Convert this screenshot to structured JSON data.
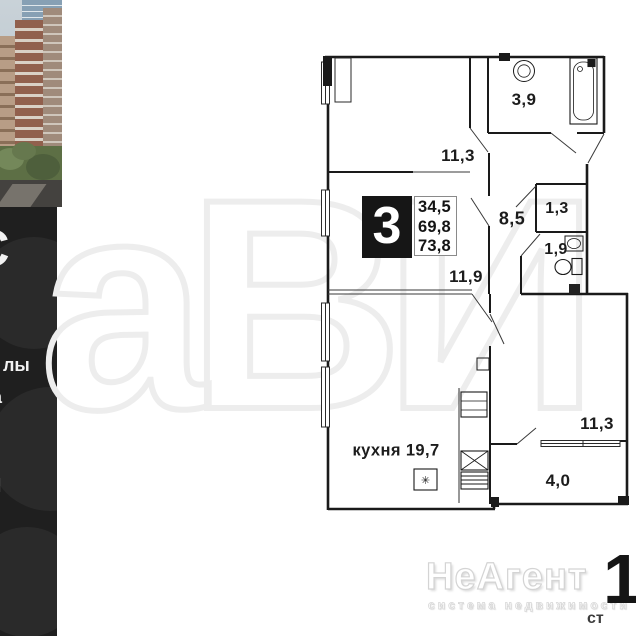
{
  "listing_badge": {
    "rooms": "3",
    "areas": [
      "34,5",
      "69,8",
      "73,8"
    ]
  },
  "floorplan": {
    "room_labels": [
      {
        "name": "bathroom",
        "text": "3,9"
      },
      {
        "name": "room-top",
        "text": "11,3"
      },
      {
        "name": "hallway",
        "text": "8,5"
      },
      {
        "name": "closet",
        "text": "1,3"
      },
      {
        "name": "wc",
        "text": "1,9"
      },
      {
        "name": "room-middle",
        "text": "11,9"
      },
      {
        "name": "kitchen",
        "text": "кухня 19,7"
      },
      {
        "name": "room-bottom",
        "text": "11,3"
      },
      {
        "name": "balcony",
        "text": "4,0"
      }
    ],
    "washer_symbol": "✳",
    "fixture_icons": [
      "bathtub-icon",
      "sink-icon",
      "toilet-icon",
      "oven-icon",
      "hob-icon",
      "kitchen-sink-icon",
      "washing-machine-icon",
      "window-icon"
    ]
  },
  "left_strip": {
    "photo_name": "residential-complex-photo",
    "fragments": {
      "big": "С",
      "mid": "лы",
      "small": "а",
      "lower": "И"
    }
  },
  "watermarks": {
    "brand": "НеАгент",
    "tagline": "система недвижимости",
    "background_letters": "аВИ",
    "corner_digit": "1",
    "corner_text": "ст"
  },
  "colors": {
    "panel_black": "#1f1f1f",
    "plan_line": "#1a1a1a",
    "badge_black": "#161616",
    "watermark_gray": "#ededed"
  }
}
